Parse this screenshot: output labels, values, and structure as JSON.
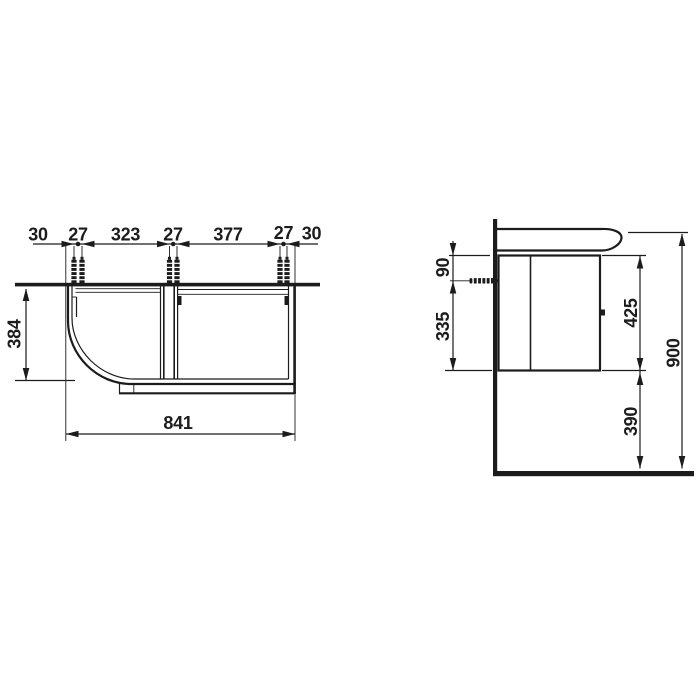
{
  "document": {
    "type_label": "technical installation drawing",
    "colors": {
      "line": "#1c1c1c",
      "background": "#ffffff"
    }
  },
  "plan_view": {
    "top_dimension_chain": [
      "30",
      "27",
      "323",
      "27",
      "377",
      "27",
      "30"
    ],
    "depth": "384",
    "width": "841",
    "icons": [
      "wall-anchor-icon"
    ]
  },
  "side_view": {
    "anchor_top_offset": "90",
    "anchor_bottom_span": "335",
    "cabinet_height": "425",
    "bottom_clearance": "390",
    "total_height": "900",
    "icons": [
      "wall-anchor-icon",
      "wall",
      "floor",
      "washbasin",
      "cabinet",
      "door-handle"
    ]
  }
}
